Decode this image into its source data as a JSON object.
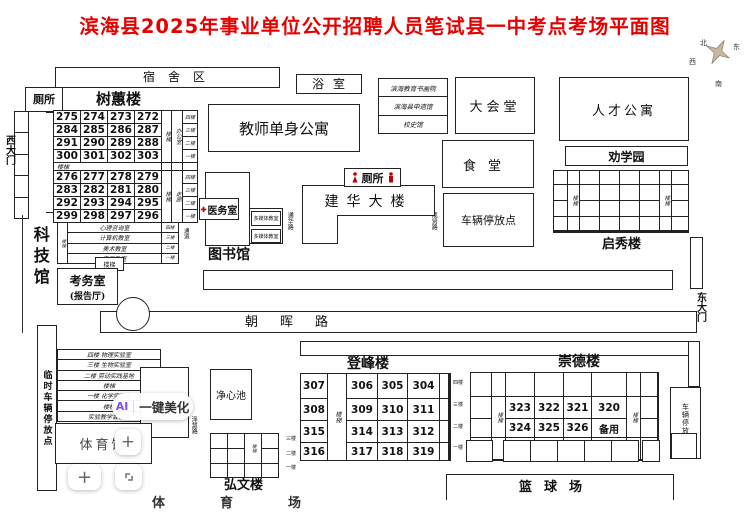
{
  "title": "滨海县2025年事业单位公开招聘人员笔试县一中考点考场平面图",
  "compass": {
    "north": "北",
    "south": "南",
    "east": "东",
    "west": "西"
  },
  "icons": {
    "cross": "✚",
    "plus": "+"
  },
  "top": {
    "dorm_area": "宿舍区",
    "bath": "浴室",
    "toilet_nw": "厕所",
    "west_gate": "西大门",
    "shuhui": {
      "name": "树蕙楼",
      "stair": "楼梯",
      "office": "办公室",
      "corridor": "走廊",
      "mid_stair": "楼梯",
      "floors": [
        "四楼",
        "三楼",
        "二楼",
        "一楼"
      ],
      "g1": [
        [
          "275",
          "274",
          "273",
          "272"
        ],
        [
          "284",
          "285",
          "286",
          "287"
        ],
        [
          "291",
          "290",
          "289",
          "288"
        ],
        [
          "300",
          "301",
          "302",
          "303"
        ]
      ],
      "g2": [
        [
          "276",
          "277",
          "278",
          "279"
        ],
        [
          "283",
          "282",
          "281",
          "280"
        ],
        [
          "292",
          "293",
          "294",
          "295"
        ],
        [
          "299",
          "298",
          "297",
          "296"
        ]
      ]
    },
    "teacher_apartment": "教师单身公寓",
    "annex": [
      "滨海教育书画院",
      "滨海县申遗馆",
      "校史馆"
    ],
    "auditorium": "大会堂",
    "canteen": "食堂",
    "talent_apartment": "人才公寓",
    "quanxue_garden": "劝学园",
    "qixiu": {
      "name": "启秀楼",
      "stair": "楼梯"
    }
  },
  "middle": {
    "medical": "医务室",
    "library": "图书馆",
    "media_room": "多媒体教室",
    "toilet_mid": "厕所",
    "jianhua": "建华大楼",
    "parking_mid": "车辆停放点",
    "roads": {
      "v1": "成贤路",
      "v2": "通华路",
      "v3": "泽慧路",
      "zhaohui": "朝晖路"
    },
    "keji": "科技馆",
    "yifu": {
      "stair": "楼梯",
      "passage": "通道",
      "rooms": [
        "心理咨询室",
        "计算机教室",
        "美术教室",
        "音乐教室"
      ],
      "floors": [
        "四楼",
        "三楼",
        "二楼",
        "一楼"
      ]
    },
    "stair_box": "楼梯",
    "kaowu": {
      "line1": "考务室",
      "line2": "(报告厅)"
    },
    "east_gate": "东大门"
  },
  "bottom": {
    "linshi_parking": "临时车辆停放点",
    "lab_rows": [
      "四楼 物理实验室",
      "三楼 生物实验室",
      "二楼 劳动实践基地",
      "楼梯",
      "一楼 化学实验室",
      "楼梯",
      "实验教学会议室"
    ],
    "gym": "体育馆",
    "jingxin": "净心池",
    "dengfeng": {
      "name": "登峰楼",
      "stair": "楼梯",
      "floors": [
        "四楼",
        "三楼",
        "二楼",
        "一楼"
      ],
      "rows": [
        [
          "307",
          "306",
          "305",
          "304"
        ],
        [
          "308",
          "309",
          "310",
          "311"
        ],
        [
          "315",
          "314",
          "313",
          "312"
        ],
        [
          "316",
          "317",
          "318",
          "319"
        ]
      ]
    },
    "chongde": {
      "name": "崇德楼",
      "stair": "楼梯",
      "rows": [
        [
          "323",
          "322",
          "321",
          "320"
        ],
        [
          "324",
          "325",
          "326",
          "备用"
        ]
      ]
    },
    "hongwen": {
      "name": "弘文楼",
      "stair": "楼梯",
      "floors": [
        "三楼",
        "二楼",
        "一楼"
      ]
    },
    "parking_right": "车辆停放点",
    "basketball": "篮球场",
    "sports_field": "体育场"
  },
  "watermark": {
    "ai": "AI",
    "beautify": "一键美化"
  },
  "colors": {
    "title_red": "#e60000",
    "line": "#222222",
    "icon_red": "#c00000",
    "ai_purple": "#7c4dff"
  }
}
